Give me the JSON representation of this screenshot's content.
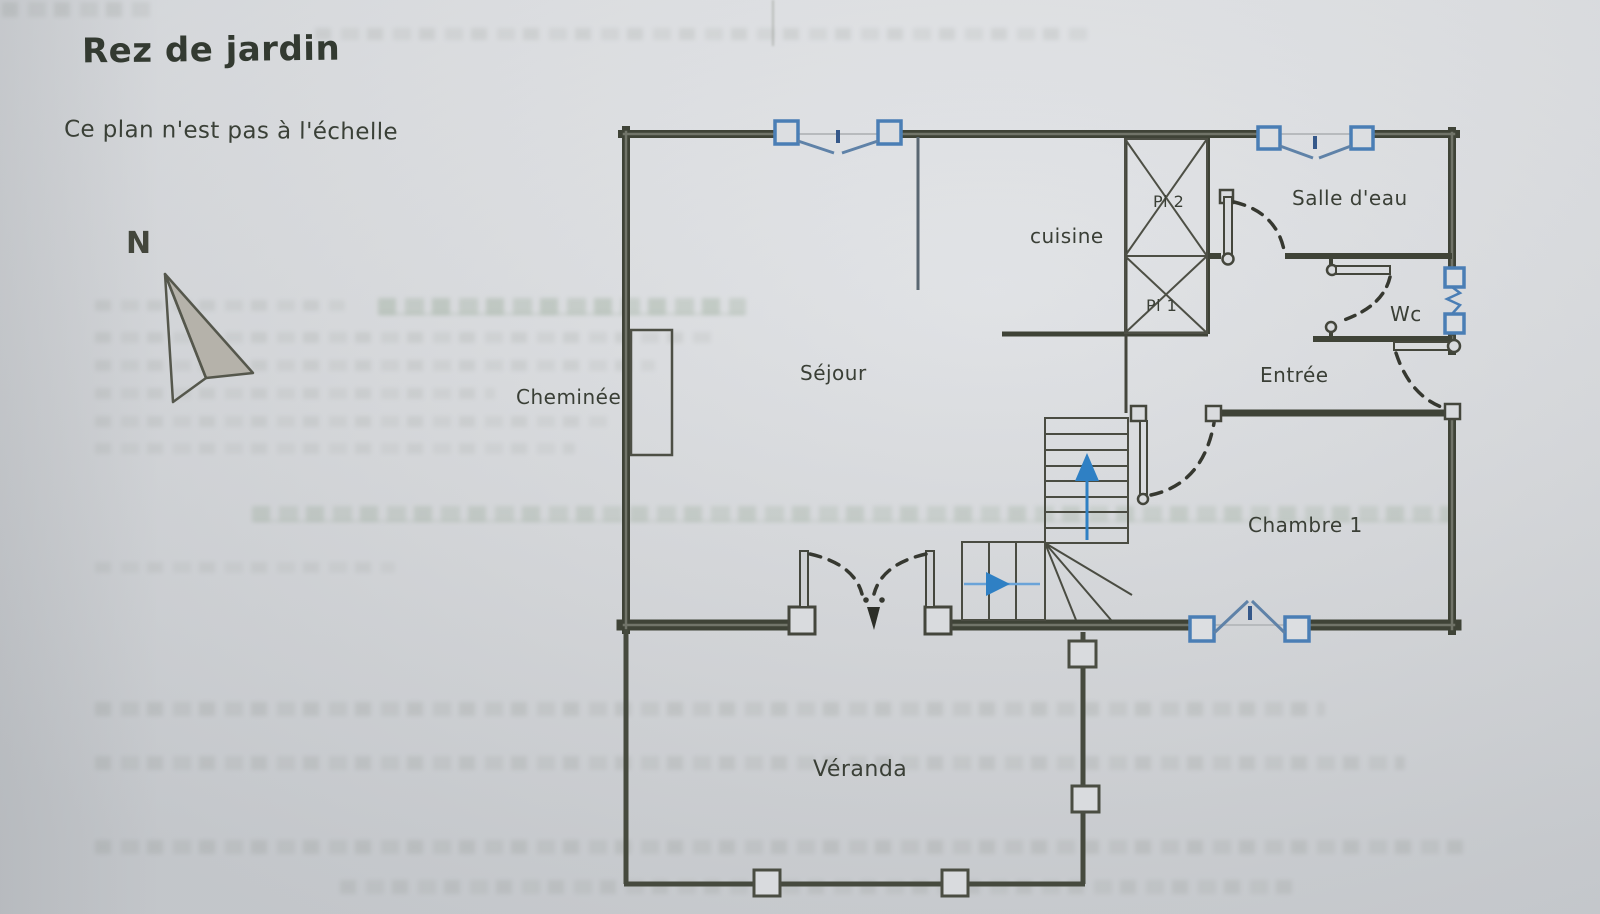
{
  "page": {
    "title": "Rez de jardin",
    "scale_note": "Ce plan n'est pas à l'échelle"
  },
  "compass": {
    "label": "N"
  },
  "rooms": {
    "cheminee": {
      "label": "Cheminée"
    },
    "sejour": {
      "label": "Séjour"
    },
    "cuisine": {
      "label": "cuisine"
    },
    "placard_2": {
      "label": "Pl 2"
    },
    "placard_1": {
      "label": "Pl 1"
    },
    "salle_deau": {
      "label": "Salle d'eau"
    },
    "wc": {
      "label": "Wc"
    },
    "entree": {
      "label": "Entrée"
    },
    "chambre_1": {
      "label": "Chambre 1"
    },
    "veranda": {
      "label": "Véranda"
    }
  },
  "colors": {
    "paper": "#d9dbde",
    "wall_dark": "#3f4337",
    "thin_line": "#4d4f45",
    "window_blue": "#4a7eb5",
    "arrow_blue": "#2f80c4",
    "label_text": "#3a3f36"
  }
}
